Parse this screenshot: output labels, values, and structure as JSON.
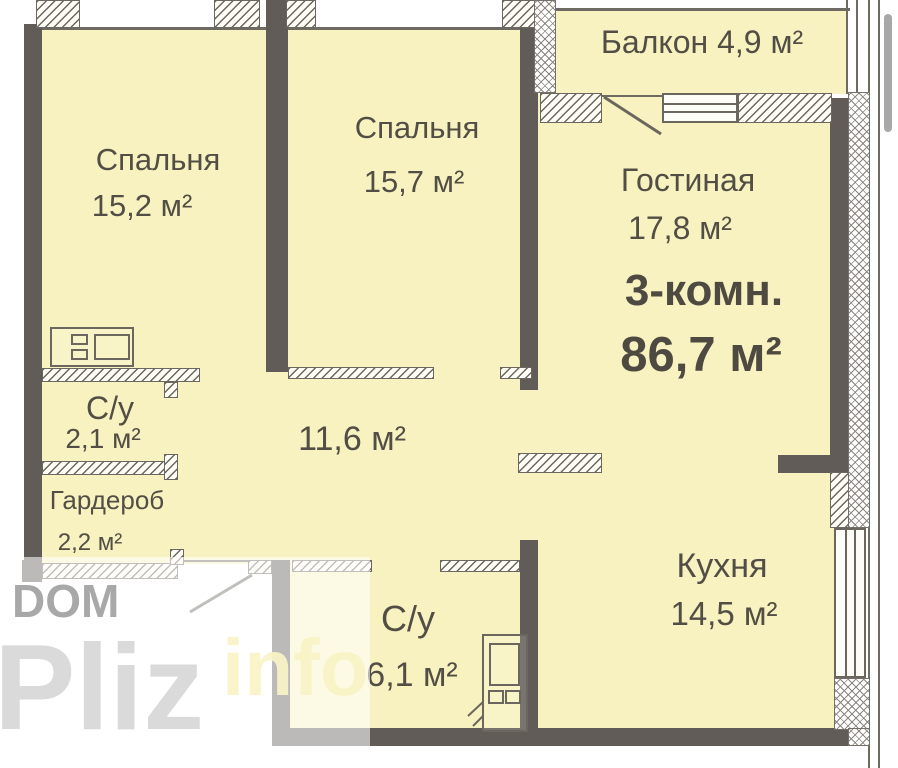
{
  "title": {
    "type_label": "3-комн.",
    "total_area": "86,7 м²"
  },
  "rooms": {
    "bedroom1": {
      "name": "Спальня",
      "area": "15,2 м²"
    },
    "bedroom2": {
      "name": "Спальня",
      "area": "15,7 м²"
    },
    "balcony": {
      "name": "Балкон",
      "area": "4,9 м²",
      "label": "Балкон 4,9 м²"
    },
    "living": {
      "name": "Гостиная",
      "area": "17,8 м²"
    },
    "bath1": {
      "name": "С/у",
      "area": "2,1 м²"
    },
    "wardrobe": {
      "name": "Гардероб",
      "area": "2,2 м²"
    },
    "hall": {
      "area": "11,6 м²"
    },
    "kitchen": {
      "name": "Кухня",
      "area": "14,5 м²"
    },
    "bath2": {
      "name": "С/у",
      "area": "6,1 м²"
    }
  },
  "watermark": {
    "dom": "DOM",
    "pliz": "Pliz",
    "info": "info"
  },
  "colors": {
    "room_fill": "#f7f2bf",
    "wall": "#615c58",
    "label_text": "#524e45",
    "hatch_line": "#6b675f",
    "watermark_gray": "#d7d7d7"
  }
}
